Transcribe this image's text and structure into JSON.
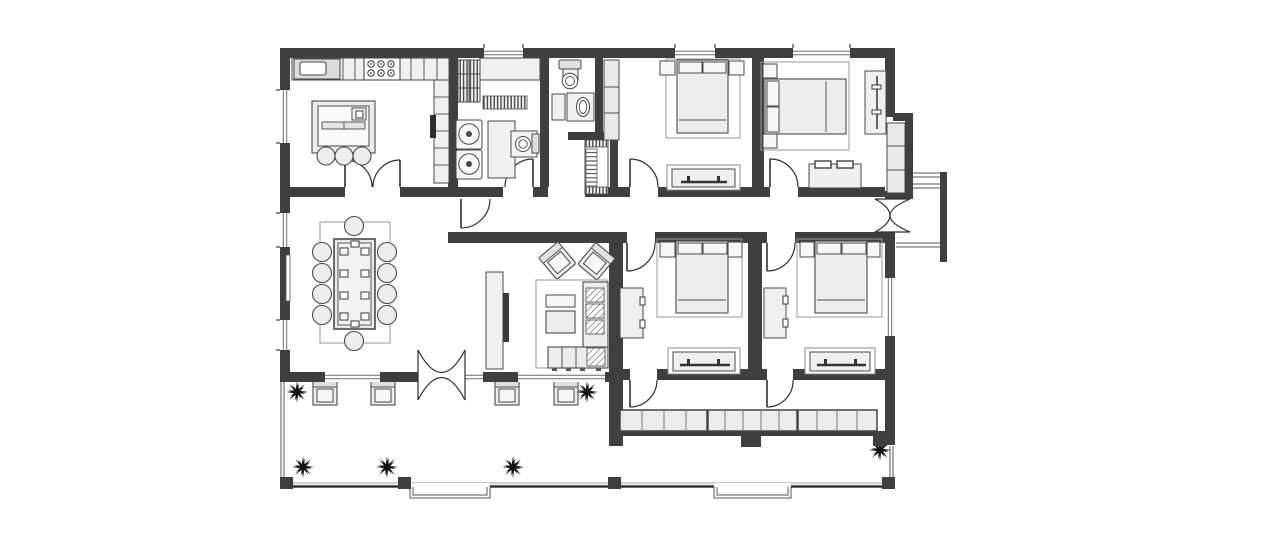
{
  "document": {
    "title": "House floor plan — single-story residence with porch",
    "type": "architectural-floor-plan",
    "background": "#ffffff"
  },
  "colors": {
    "wall": "#3f3f3f",
    "furniture_outline": "#4a4a4a",
    "furniture_fill": "#ededed",
    "furniture_fill_light": "#f7f7f7",
    "rug_outline": "#999999",
    "plant": "#141414",
    "window_line": "#6b6b6b",
    "tv_dark": "#3a3a3a",
    "background": "#ffffff"
  },
  "rooms": [
    {
      "name": "kitchen",
      "furniture": [
        "counter-with-sink",
        "stove-6-burner",
        "cabinet-run",
        "side-counter",
        "radiator",
        "island-counter",
        "bar-stool-x3",
        "double-door-to-dining"
      ]
    },
    {
      "name": "utility-room",
      "furniture": [
        "slatted-shelving",
        "counter",
        "doormat",
        "washing-machine-x2",
        "side-table",
        "toilet",
        "door-to-corridor"
      ]
    },
    {
      "name": "bathroom",
      "furniture": [
        "toilet",
        "cabinet",
        "vanity-sink"
      ]
    },
    {
      "name": "hall-nook",
      "furniture": [
        "slatted-linen-cabinet"
      ]
    },
    {
      "name": "bedroom-1",
      "furniture": [
        "wardrobe",
        "double-bed",
        "nightstand-x2",
        "tv-bench"
      ]
    },
    {
      "name": "bedroom-2",
      "furniture": [
        "double-bed",
        "nightstand-x2",
        "desk",
        "wardrobe",
        "dresser-with-trays"
      ]
    },
    {
      "name": "dining-room",
      "furniture": [
        "dining-table",
        "chair-x10",
        "rug",
        "radiator"
      ]
    },
    {
      "name": "living-room",
      "furniture": [
        "tv-console",
        "tv",
        "armchair-x2",
        "coffee-table-x2",
        "corner-sofa",
        "hatched-cushion-x4",
        "rug"
      ]
    },
    {
      "name": "bedroom-3",
      "furniture": [
        "double-bed",
        "nightstand-x2",
        "wall-cabinet",
        "tv-bench"
      ]
    },
    {
      "name": "bedroom-4",
      "furniture": [
        "double-bed",
        "nightstand-x2",
        "wall-cabinet",
        "tv-bench"
      ]
    },
    {
      "name": "central-corridor",
      "furniture": [
        "corridor-door"
      ]
    },
    {
      "name": "rear-corridor",
      "furniture": [
        "glazed-window-band-13-panes"
      ]
    },
    {
      "name": "entrance",
      "furniture": [
        "double-swing-door",
        "stoop-with-steps"
      ]
    },
    {
      "name": "porch",
      "furniture": [
        "armchair-x4",
        "plant-x6",
        "column-x4",
        "step-x2",
        "double-swing-door-to-living"
      ]
    }
  ],
  "counts": {
    "bedrooms": 4,
    "bathrooms": 2,
    "dining_chairs": 10,
    "bar_stools": 3,
    "porch_armchairs": 4,
    "plants": 6,
    "washing_machines": 2,
    "porch_columns": 4,
    "exterior_windows": 10,
    "window_band_panes": 13,
    "double_swing_doors": 2
  }
}
